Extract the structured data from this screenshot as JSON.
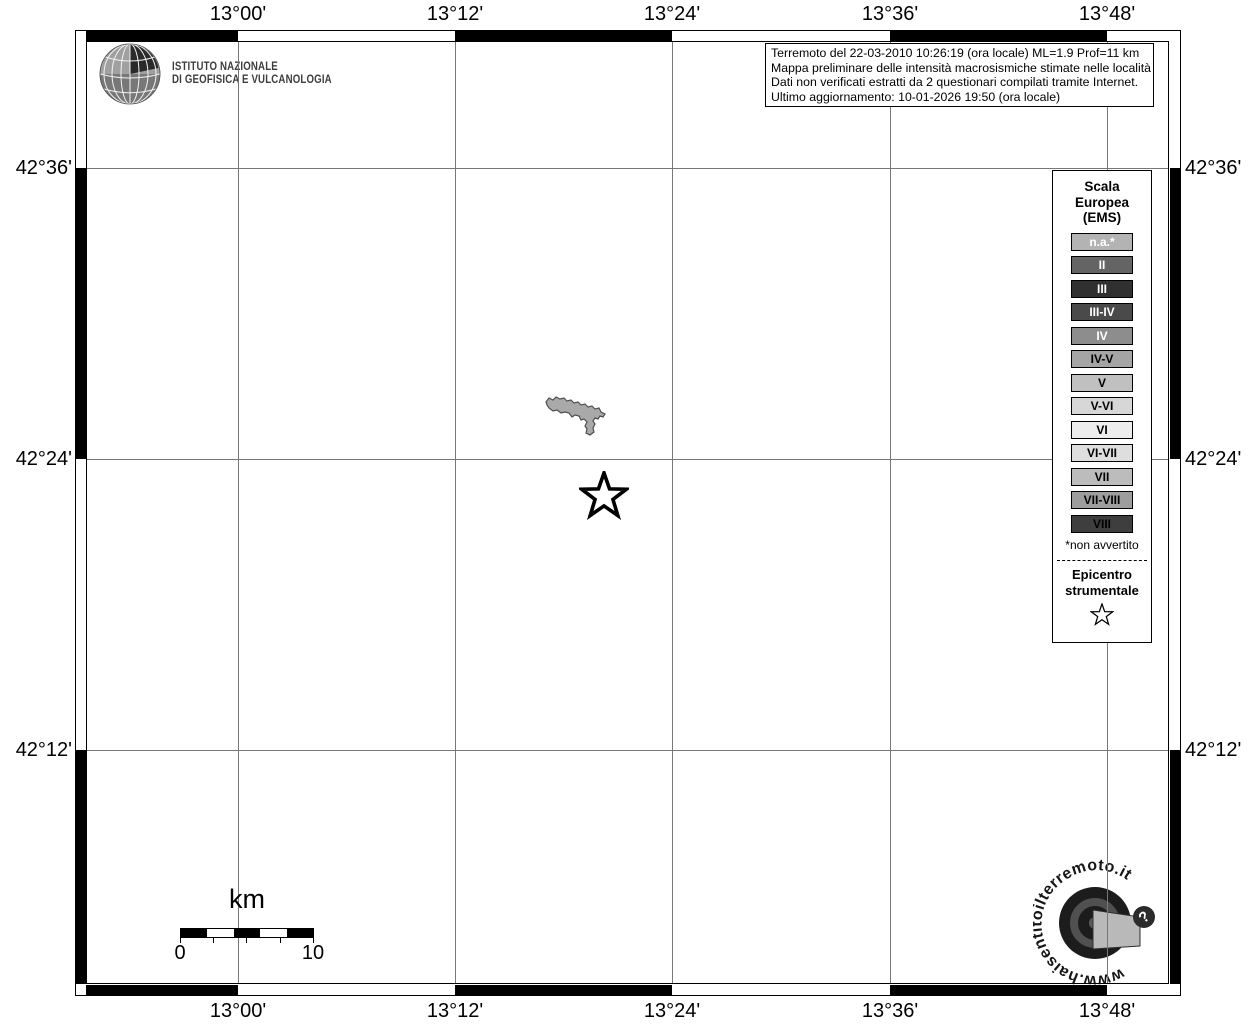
{
  "title_block": {
    "institute_line1": "ISTITUTO NAZIONALE",
    "institute_line2": "DI GEOFISICA E VULCANOLOGIA"
  },
  "info_box": {
    "line1": "Terremoto del 22-03-2010 10:26:19 (ora locale) ML=1.9 Prof=11 km",
    "line2": "Mappa preliminare delle intensità macrosismiche stimate nelle località",
    "line3": "Dati non verificati estratti da 2 questionari compilati tramite Internet.",
    "line4": "Ultimo aggiornamento: 10-01-2026 19:50 (ora locale)"
  },
  "axes": {
    "lon_labels": [
      "13°00'",
      "13°12'",
      "13°24'",
      "13°36'",
      "13°48'"
    ],
    "lat_labels": [
      "42°36'",
      "42°24'",
      "42°12'"
    ]
  },
  "legend": {
    "title_line1": "Scala",
    "title_line2": "Europea",
    "title_line3": "(EMS)",
    "items": [
      {
        "label": "n.a.*",
        "bg": "#b3b3b3",
        "fg": "#ffffff"
      },
      {
        "label": "II",
        "bg": "#646464",
        "fg": "#ffffff"
      },
      {
        "label": "III",
        "bg": "#303030",
        "fg": "#ffffff"
      },
      {
        "label": "III-IV",
        "bg": "#4a4a4a",
        "fg": "#ffffff"
      },
      {
        "label": "IV",
        "bg": "#8d8d8d",
        "fg": "#ffffff"
      },
      {
        "label": "IV-V",
        "bg": "#a5a5a5",
        "fg": "#000000"
      },
      {
        "label": "V",
        "bg": "#c0c0c0",
        "fg": "#000000"
      },
      {
        "label": "V-VI",
        "bg": "#d7d7d7",
        "fg": "#000000"
      },
      {
        "label": "VI",
        "bg": "#ededed",
        "fg": "#000000"
      },
      {
        "label": "VI-VII",
        "bg": "#dedede",
        "fg": "#000000"
      },
      {
        "label": "VII",
        "bg": "#bcbcbc",
        "fg": "#000000"
      },
      {
        "label": "VII-VIII",
        "bg": "#9d9d9d",
        "fg": "#000000"
      },
      {
        "label": "VIII",
        "bg": "#3e3e3e",
        "fg": "#000000"
      }
    ],
    "footnote": "*non avvertito",
    "epicenter_line1": "Epicentro",
    "epicenter_line2": "strumentale"
  },
  "scalebar": {
    "unit": "km",
    "start_label": "0",
    "end_label": "10"
  },
  "branding": {
    "site_text": "www.haisentitoilterremoto.it",
    "question_mark": "?"
  },
  "map": {
    "epicenter_symbol": "star-outline-icon",
    "lake_fill": "#a9a9a9",
    "grid_color": "#777777"
  }
}
